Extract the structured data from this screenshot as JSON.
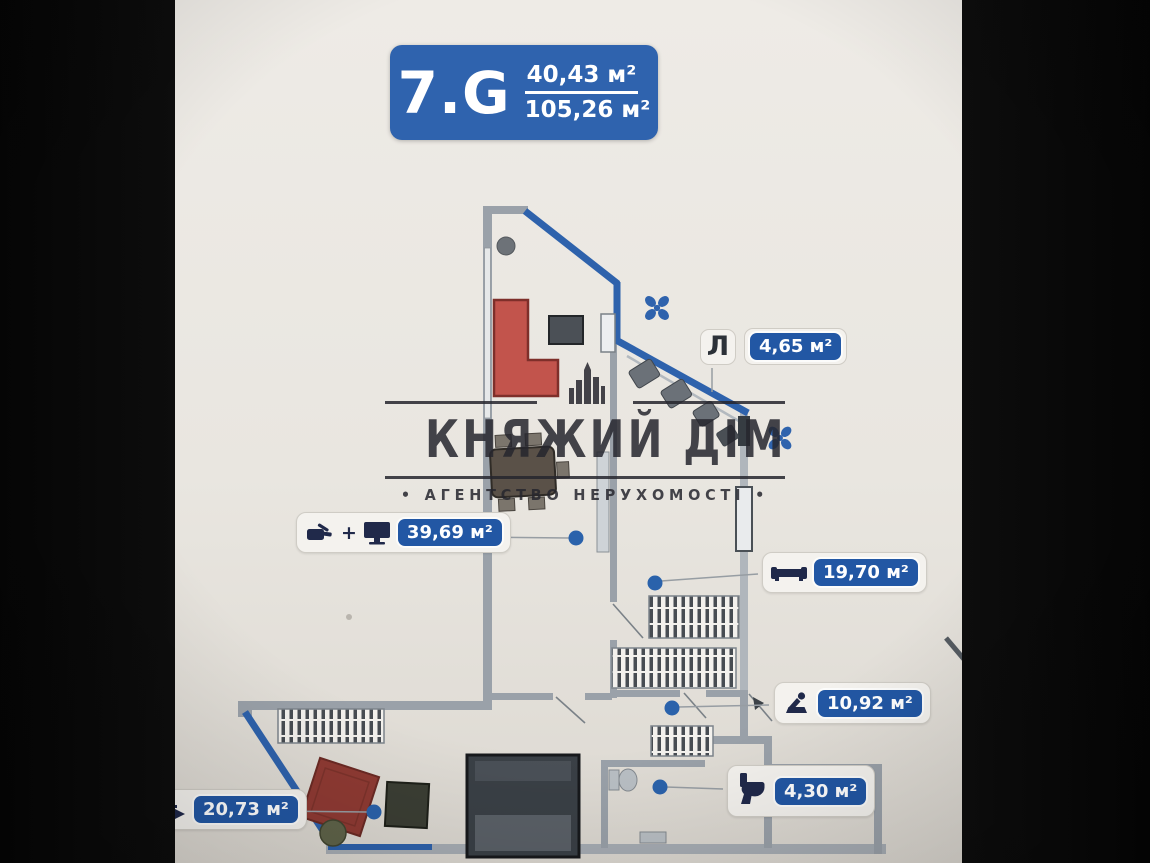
{
  "badge": {
    "unit": "7.G",
    "area_upper": "40,43 м²",
    "area_total": "105,26 м²"
  },
  "watermark": {
    "title": "КНЯЖИЙ ДІМ",
    "subtitle": "АГЕНТСТВО НЕРУХОМОСТІ",
    "bullet": "•"
  },
  "labels": {
    "loggia": {
      "letter": "Л",
      "area": "4,65 м²"
    },
    "kitchen_living": {
      "plus": "+",
      "area": "39,69 м²"
    },
    "living_room": {
      "area": "19,70 м²"
    },
    "bathroom": {
      "area": "10,92 м²"
    },
    "wc": {
      "area": "4,30 м²"
    },
    "bedroom": {
      "area": "20,73 м²"
    }
  },
  "colors": {
    "badge_blue": "#2f63ae",
    "pill_blue": "#2257a4",
    "window_wall_blue": "#2e62ac",
    "wall_gray": "#9aa1a9",
    "sofa_red": "#c2544c",
    "rug_red": "#8f3a33",
    "icon_navy": "#20294a",
    "marker_dot_blue": "#2a62ab",
    "fan_blue": "#2f63ad",
    "paper": "#e9e6e0"
  }
}
